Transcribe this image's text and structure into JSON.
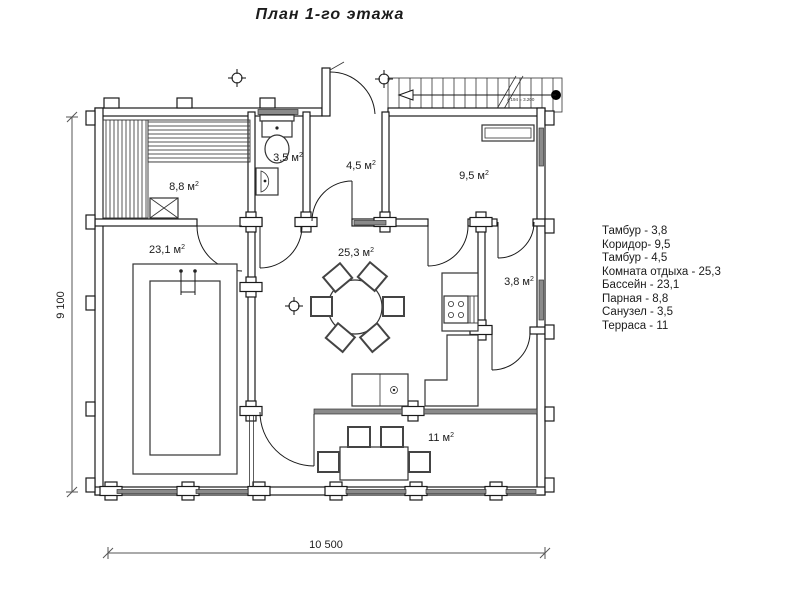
{
  "title": "План 1-го этажа",
  "unit_sup": "2",
  "rooms": {
    "parnaya": {
      "label": "8,8 м"
    },
    "sanuzel": {
      "label": "3,5 м"
    },
    "tambur1": {
      "label": "4,5 м"
    },
    "koridor": {
      "label": "9,5 м"
    },
    "bassein": {
      "label": "23,1 м"
    },
    "komnata": {
      "label": "25,3 м"
    },
    "tambur2": {
      "label": "3,8 м"
    },
    "terrasa": {
      "label": "11 м"
    }
  },
  "dimensions": {
    "width": "10 500",
    "height": "9 100"
  },
  "stairs": {
    "note": "x 194 = 3.200"
  },
  "legend": {
    "items": [
      "Тамбур - 3,8",
      "Коридор- 9,5",
      "Тамбур - 4,5",
      "Комната отдыха  - 25,3",
      "Бассейн - 23,1",
      "Парная - 8,8",
      "Санузел - 3,5",
      "Терраса - 11"
    ]
  }
}
